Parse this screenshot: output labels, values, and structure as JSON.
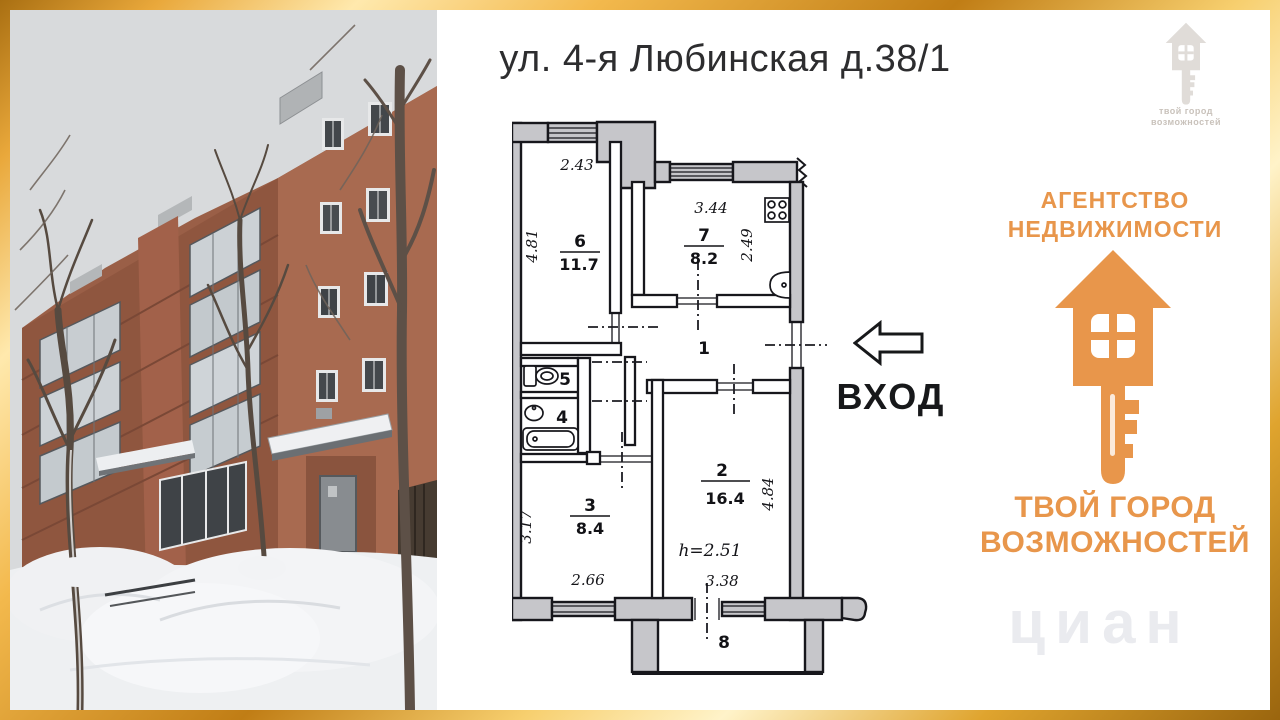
{
  "title": "ул. 4-я Любинская д.38/1",
  "photo": {
    "description": "five-storey red brick apartment building in winter, snow drifts and bare trees"
  },
  "floor_plan": {
    "entrance_label": "ВХОД",
    "rooms": [
      {
        "number": "6",
        "area": "11.7",
        "width_label": "2.43",
        "height_label": "4.81"
      },
      {
        "number": "7",
        "area": "8.2",
        "width_label": "3.44",
        "height_label": "2.49"
      },
      {
        "number": "1"
      },
      {
        "number": "5"
      },
      {
        "number": "4"
      },
      {
        "number": "3",
        "area": "8.4",
        "width_label": "2.66",
        "height_label": "3.17"
      },
      {
        "number": "2",
        "area": "16.4",
        "width_label": "3.38",
        "height_label": "4.84",
        "ceiling_height": "h=2.51"
      },
      {
        "number": "8"
      }
    ]
  },
  "branding": {
    "agency_line1": "АГЕНТСТВО",
    "agency_line2": "НЕДВИЖИМОСТИ",
    "slogan_line1": "ТВОЙ ГОРОД",
    "slogan_line2": "ВОЗМОЖНОСТЕЙ",
    "accent_color": "#E8964B"
  },
  "watermarks": {
    "corner_line1": "твой город",
    "corner_line2": "возможностей",
    "photo_watermark": "циан"
  },
  "colors": {
    "frame_gold": "#E2A23B",
    "plan_wall_gray": "#C6C6CA"
  }
}
